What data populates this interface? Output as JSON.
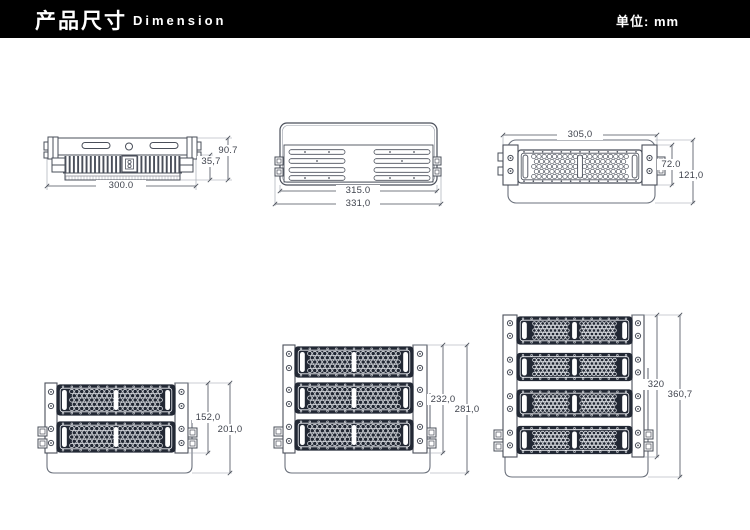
{
  "header": {
    "title_zh": "产品尺寸",
    "title_en": "Dimension",
    "unit_label": "单位: mm"
  },
  "colors": {
    "header_bg": "#000000",
    "header_text": "#ffffff",
    "line": "#4a4f5a",
    "line_mid": "#6b717c",
    "line_light": "#989ea8",
    "module_dark": "#222834",
    "dim_text": "#3f434d"
  },
  "drawings": {
    "side_view": {
      "dims": {
        "width": "300.0",
        "body_height": "35,7",
        "total_height": "90.7"
      }
    },
    "back_view": {
      "dims": {
        "body_width": "315.0",
        "overall_width": "331,0"
      }
    },
    "front_view": {
      "dims": {
        "width": "305,0",
        "module_height": "72.0",
        "total_height": "121,0"
      }
    },
    "two_module": {
      "dims": {
        "frame_height": "152,0",
        "total_height": "201,0"
      }
    },
    "three_module": {
      "dims": {
        "frame_height": "232,0",
        "total_height": "281,0"
      }
    },
    "four_module": {
      "dims": {
        "frame_height": "320",
        "total_height": "360,7"
      }
    }
  }
}
